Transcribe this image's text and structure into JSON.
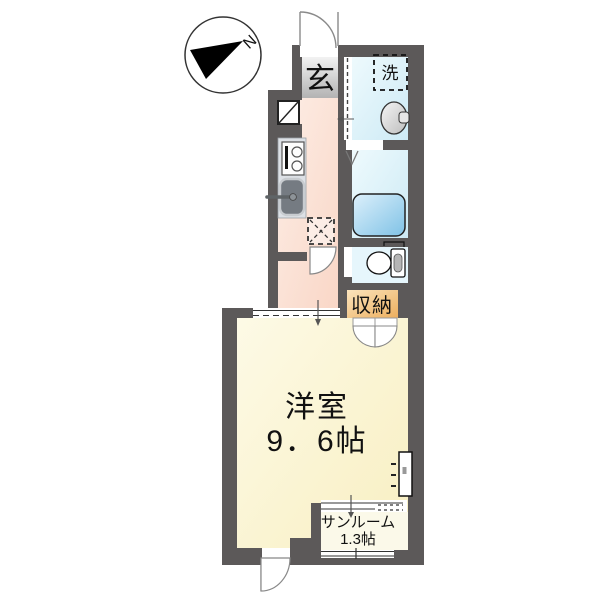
{
  "plan_type": "apartment-floor-plan",
  "compass": {
    "north_label": "N"
  },
  "rooms": {
    "entrance": {
      "label": "玄"
    },
    "laundry_mark": {
      "label": "洗"
    },
    "storage": {
      "label": "収納"
    },
    "main_room": {
      "name": "洋室",
      "size": "9．6帖"
    },
    "sunroom": {
      "name": "サンルーム",
      "size": "1.3帖"
    }
  },
  "colors": {
    "wall": "#5c5959",
    "kitchen_floor": "#fbe0d5",
    "washroom_floor": "#d9f0f8",
    "toilet_floor": "#e6f6fc",
    "bathtub": "#8fc9e9",
    "storage_fill": "#f3bd72",
    "main_room_floor": "#fbf5d2",
    "sunroom_floor": "#fbf9e9",
    "entrance_step": "#c9c9c9"
  }
}
